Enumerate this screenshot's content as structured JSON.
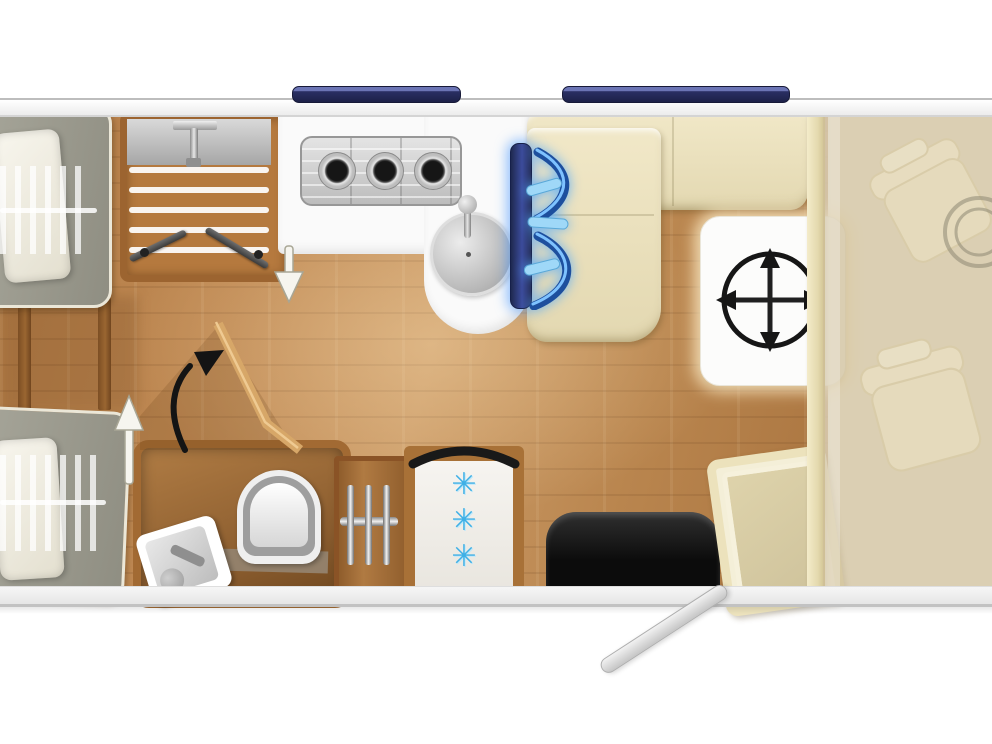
{
  "scene": {
    "type": "motorhome-floorplan-top-view",
    "visible_text": "none"
  },
  "palette": {
    "wall_white": "#f2f2f2",
    "window_navy": "#2a2f63",
    "floor_wood": "#c08a54",
    "wood_trim": "#9c6430",
    "mattress_gray": "#9a998c",
    "pillow_white": "#f4f1e6",
    "bench_cream": "#ece2bd",
    "table_white": "#fcfcfb",
    "tv_navy": "#2a3668",
    "glow_blue": "#54b4ff",
    "snowflake_blue": "#3fb0e6",
    "seat_black": "#161616",
    "cab_overlay_beige": "#cebe98",
    "steel_gray": "#c9c9c9",
    "arrow_black": "#141414",
    "arrow_white": "#f6f5ef"
  },
  "fridge": {
    "star_char": "✳",
    "star_count": 3
  },
  "parts": {
    "window_left": "Window (left)",
    "window_right": "Window (right)",
    "bed_top": "Single bed with pillow (top)",
    "bed_bottom": "Single bed with pillow (bottom)",
    "shower": "Shower cubicle with wooden grate and bifold doors",
    "worktop": "Kitchen worktop",
    "hob": "3-burner gas hob",
    "sink": "Kitchen sink with tap",
    "tv": "Swivel TV with rotation arrows",
    "bench": "L-shaped dinette bench",
    "table": "Adjustable table (moves in all directions)",
    "divider": "Cab partition",
    "cab": "Driver cab (faded)",
    "cab_seat_front": "Cab seat (front)",
    "cab_seat_rear": "Cab seat (rear)",
    "steering": "Steering wheel",
    "washroom": "Washroom",
    "toilet": "Toilet",
    "washbasin": "Washbasin with tap",
    "wardrobe": "Wardrobe with hanging rail",
    "fridge": "Refrigerator with 3-star freezer",
    "black_seat": "Bench seat (black)",
    "side_seat": "Side seat",
    "door": "Entry door (open)",
    "arrow_up": "Walkway direction arrow (up)",
    "arrow_down": "Walkway direction arrow (down)",
    "arrow_swing": "Swing direction arrow",
    "compass": "Table movement compass arrows",
    "angled_wall": "Angled washroom wall"
  },
  "icons": [
    "up-arrow-icon",
    "down-arrow-icon",
    "curved-swing-arrow-icon",
    "swivel-arrows-icon",
    "move-table-compass-icon",
    "snowflake-icon",
    "door-swing-arc-icon",
    "steering-wheel-icon"
  ]
}
